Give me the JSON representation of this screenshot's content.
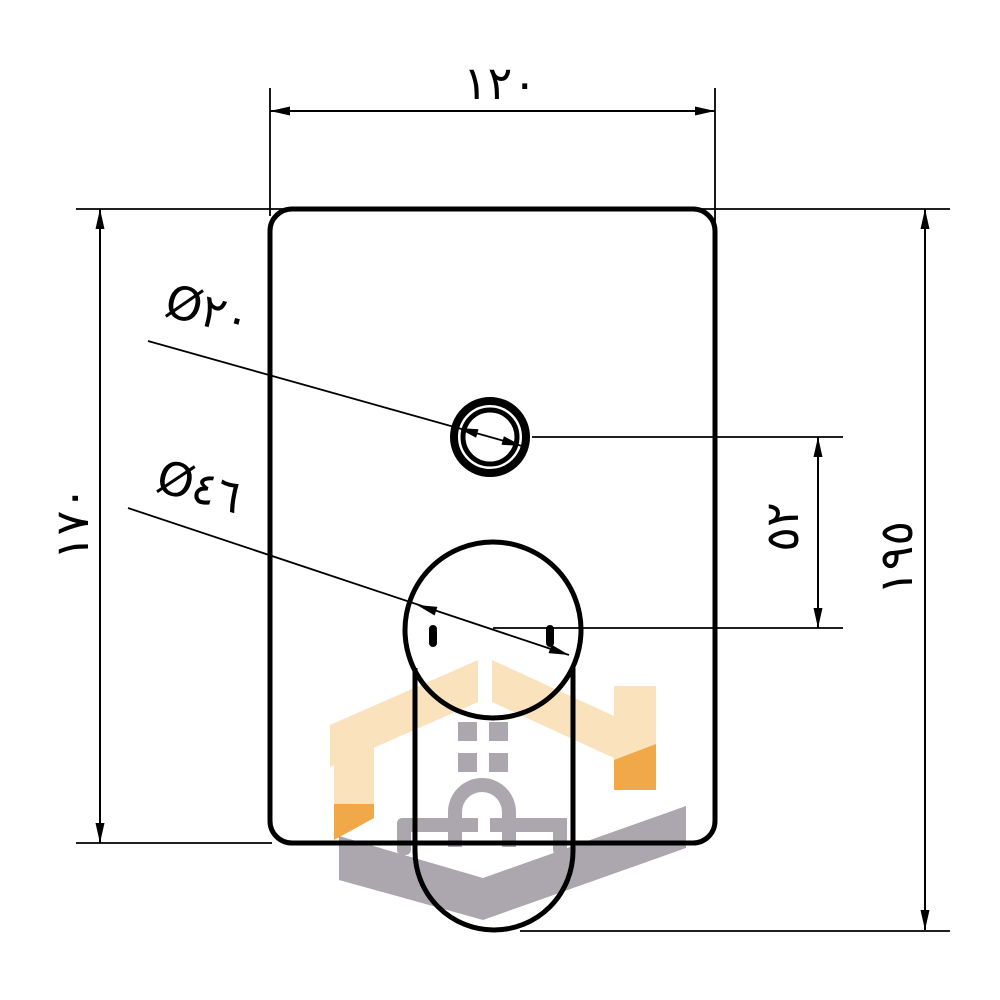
{
  "drawing": {
    "type": "technical-cad-drawing",
    "subject": "concealed-shower-mixer-trim-plate-with-lever-handle",
    "labels": {
      "width_top": "١٢٠",
      "height_left": "١٧٠",
      "height_right": "١٩٥",
      "center_distance": "٥٢",
      "small_circle_diameter": "Ø٢٠",
      "handle_diameter": "Ø٤٦"
    },
    "colors": {
      "line": "#000000",
      "background": "#ffffff",
      "watermark_peach": "#FAE2BC",
      "watermark_orange": "#F0A848",
      "watermark_gray": "#ACA7AE"
    },
    "watermark": {
      "icon": "house-logo"
    }
  }
}
